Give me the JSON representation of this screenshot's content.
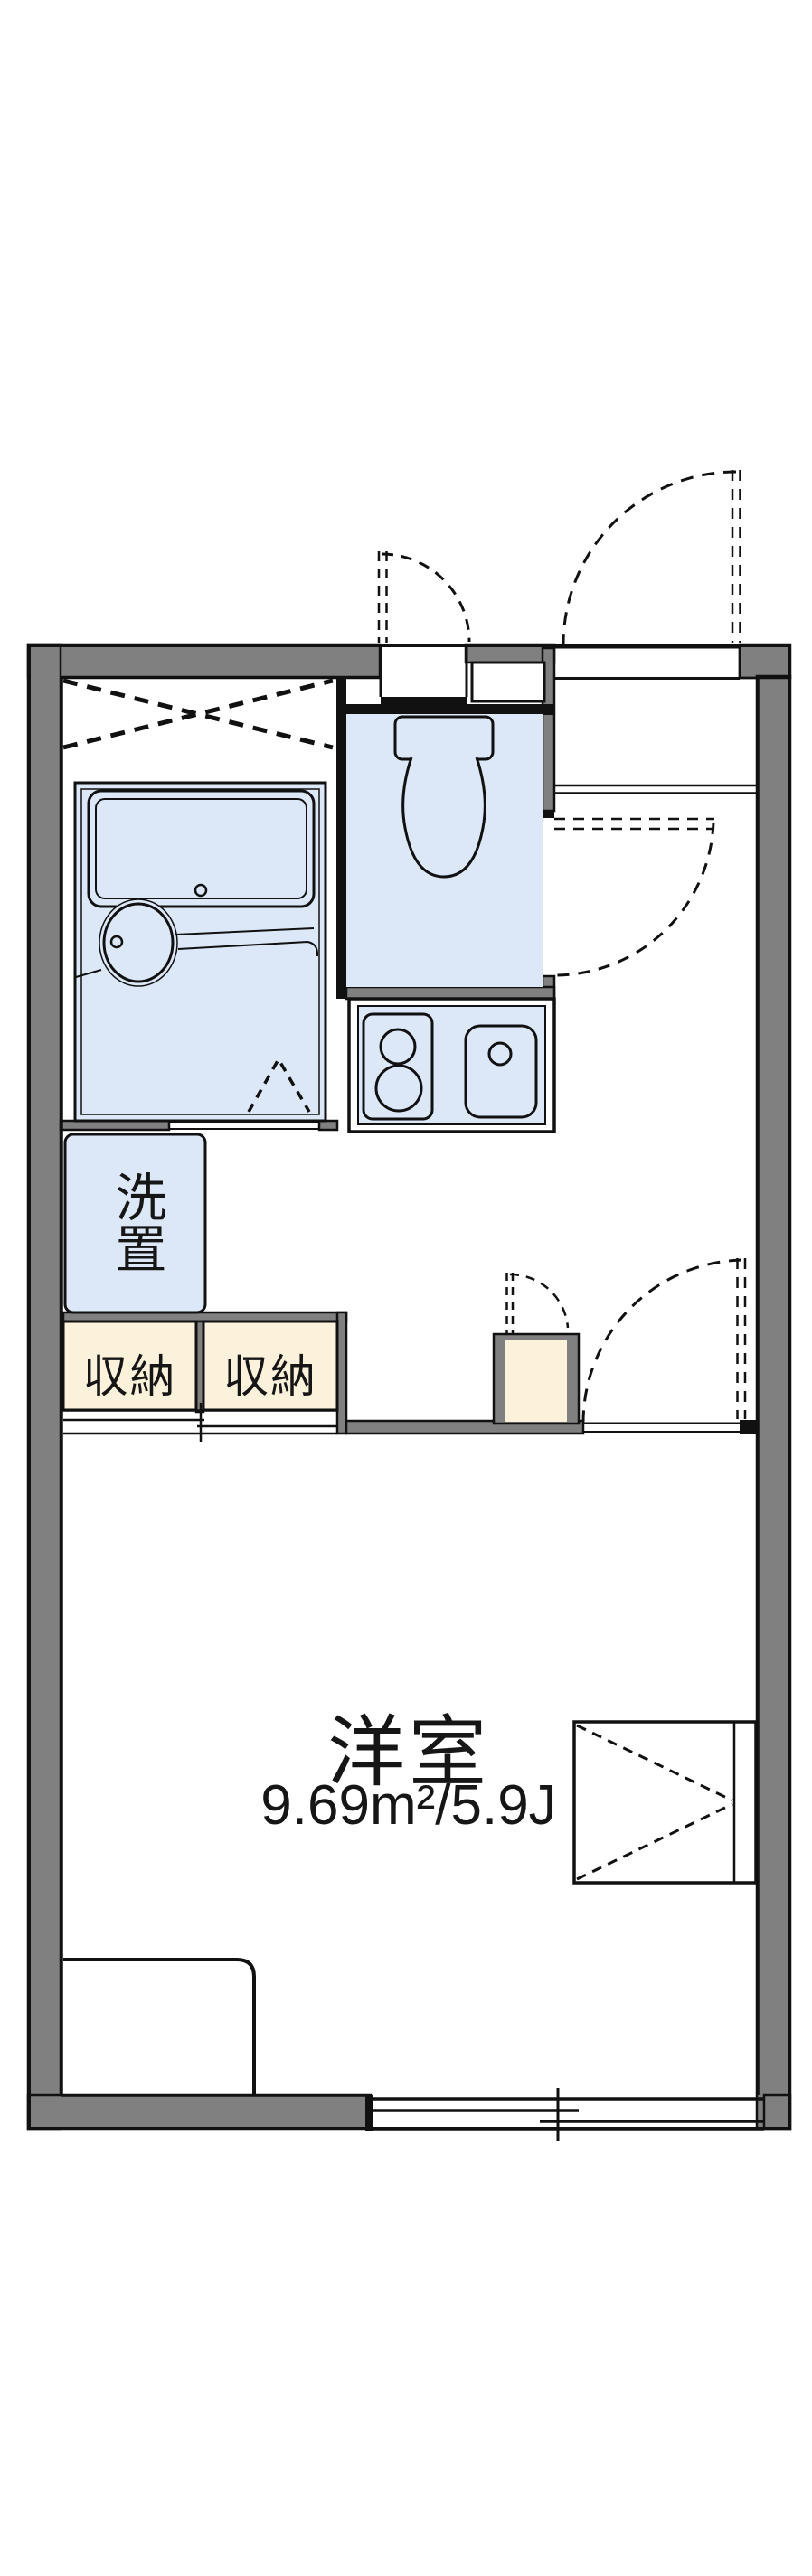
{
  "plan": {
    "title": "apartment-floor-plan",
    "labels": {
      "washer": "洗置",
      "storage_left": "収納",
      "storage_right": "収納",
      "room_name": "洋室",
      "room_area": "9.69m²/5.9J"
    },
    "colors": {
      "wall_gray": "#808080",
      "fixture_blue": "#dce8f7",
      "storage_cream": "#fcf1da",
      "line_black": "#111111",
      "background": "#ffffff"
    }
  }
}
